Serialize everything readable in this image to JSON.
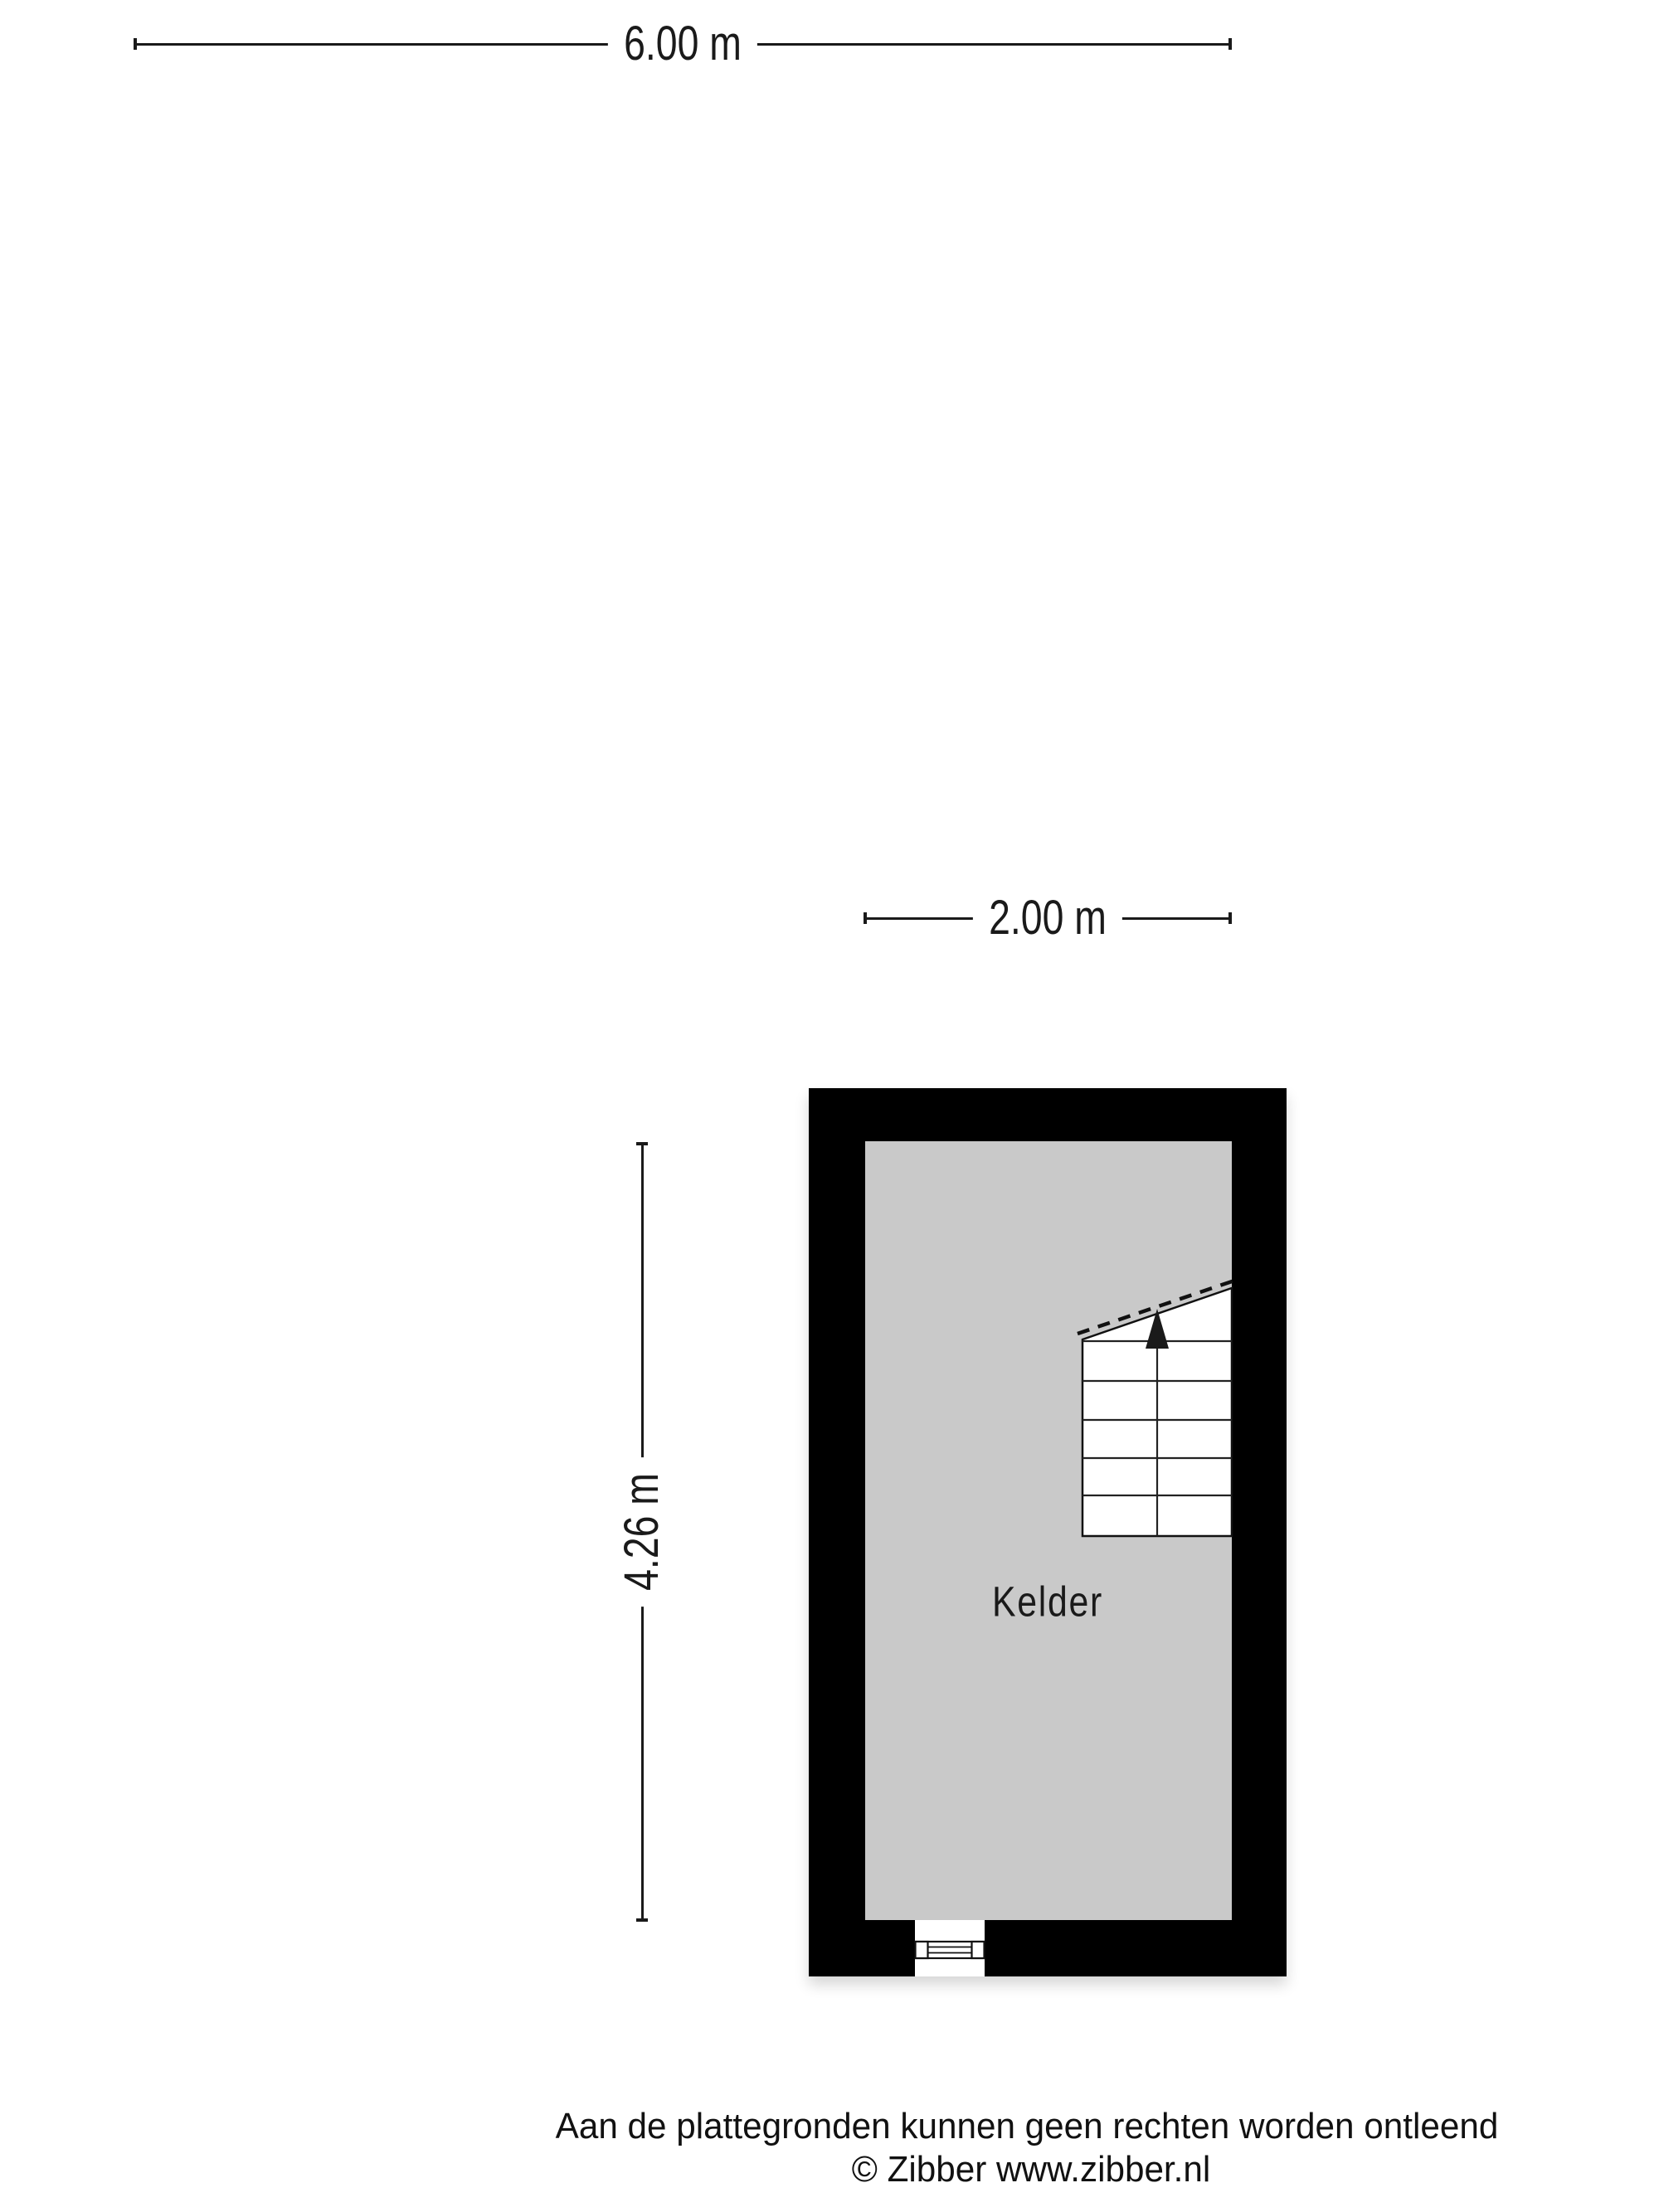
{
  "dimensions": {
    "top_width": {
      "label": "6.00 m"
    },
    "room_width": {
      "label": "2.00 m"
    },
    "room_height": {
      "label": "4.26 m"
    }
  },
  "floor_plan": {
    "room_label": "Kelder",
    "colors": {
      "wall": "#000000",
      "floor": "#c9c9c9",
      "stair_fill": "#ffffff",
      "line": "#1a1a1a"
    }
  },
  "footer": {
    "disclaimer": "Aan de plattegronden kunnen geen rechten worden ontleend",
    "copyright": "© Zibber www.zibber.nl"
  }
}
